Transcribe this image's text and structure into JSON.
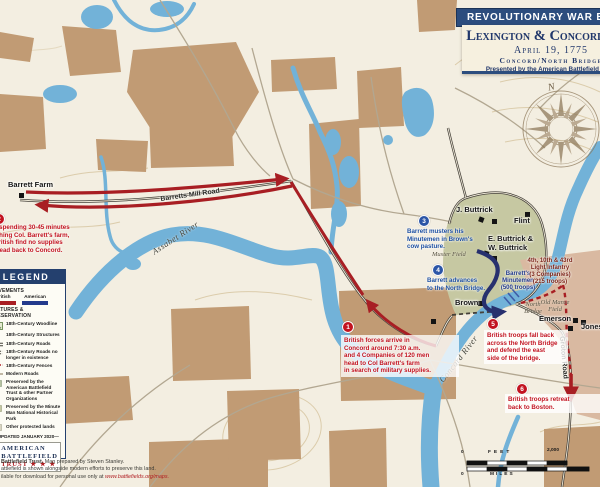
{
  "title_panel": {
    "banner": "REVOLUTIONARY WAR BATTLES",
    "title": "Lexington & Concord, MA",
    "date": "April 19, 1775",
    "subtitle": "Concord/North Bridge",
    "presented_by": "Presented by the American Battlefield Trust"
  },
  "compass": {
    "north": "N"
  },
  "legend": {
    "header": "LEGEND",
    "movements_label": "MOVEMENTS",
    "movements": {
      "british": "British",
      "american": "American"
    },
    "features_label": "FEATURES & PRESERVATION",
    "items": [
      {
        "label": "18th-Century Woodline"
      },
      {
        "label": "18th-Century Structures"
      },
      {
        "label": "18th-Century Roads"
      },
      {
        "label": "18th-Century Roads no longer in existence"
      },
      {
        "label": "18th-Century Fences"
      },
      {
        "label": "Modern Roads"
      },
      {
        "label": "Preserved by the American Battlefield Trust & other Partner Organizations"
      },
      {
        "label": "Preserved by the Minute Man National Historical Park"
      },
      {
        "label": "Other protected lands"
      }
    ],
    "updated": "UPDATED JANUARY 2020",
    "logo": {
      "line1": "AMERICAN",
      "line2": "BATTLEFIELD",
      "line3": "TRUST",
      "stars": "★ ★ ★"
    }
  },
  "callouts": [
    {
      "num": "1",
      "text": "British forces arrive in\nConcord around 7:30 a.m.\nand 4 Companies of 120 men\nhead to Col Barrett's farm\nin search of military supplies."
    },
    {
      "num": "2",
      "text": "After spending 30-45 minutes\nsearching Col. Barrett's farm,\nthe British find no supplies\nand head back to Concord."
    },
    {
      "num": "3",
      "text": "Barrett musters his\nMinutemen in Brown's\ncow pasture."
    },
    {
      "num": "4",
      "text": "Barrett advances\nto the North Bridge."
    },
    {
      "num": "5",
      "text": "British troops fall back\nacross the North Bridge\nand defend the east\nside of the bridge."
    },
    {
      "num": "6",
      "text": "British troops retreat\nback to Boston."
    }
  ],
  "labels": {
    "barrett_farm": "Barrett Farm",
    "j_buttrick": "J. Buttrick",
    "flint": "Flint",
    "e_w_buttrick": "E. Buttrick &\nW. Buttrick",
    "brown": "Brown",
    "emerson": "Emerson",
    "jones": "Jones",
    "muster_field": "Muster Field",
    "old_manse_field": "Old Manse\nField",
    "north_bridge": "North\nBridge",
    "barretts_mill_road": "Barretts Mill Road",
    "groton_road": "Groton Road",
    "assabet_river": "Assabet River",
    "concord_river": "Concord River",
    "minutemen": "Barrett's\nMinutemen\n(500 troops)",
    "light_infantry": "4th, 10th & 43rd\nLight Infantry\n(3 Companies)\n(215 troops)"
  },
  "scale": {
    "feet_label": "FEET",
    "feet_min": "0",
    "feet_max": "2,000",
    "miles_label": "MILES",
    "miles_min": "0"
  },
  "credits": {
    "line1_bold": "Battlefield Trust.",
    "line1_rest": " Map prepared by Steven Stanley.",
    "line2": "attlefield is shown alongside modern efforts to preserve this land.",
    "line3": "ilable for download for personal use only at ",
    "url": "www.battlefields.org/maps."
  }
}
